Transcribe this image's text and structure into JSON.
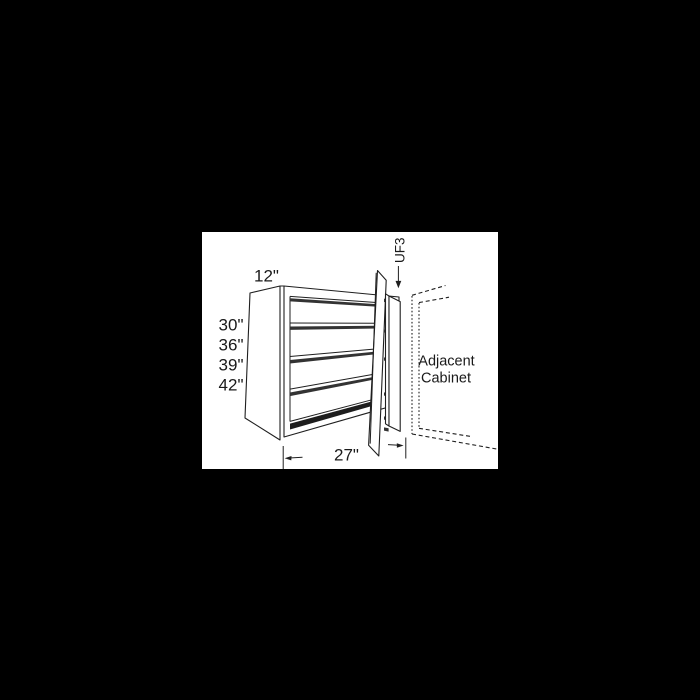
{
  "scene": {
    "background_color": "#000000",
    "paper_color": "#ffffff",
    "line_color": "#1f1f1f",
    "description": "Technical dimension drawing of a blind corner wall cabinet with open door, universal filler and adjacent cabinet shown dashed"
  },
  "diagram": {
    "type": "cabinet-dimension-drawing",
    "depth_label": "12\"",
    "height_labels": [
      "30\"",
      "36\"",
      "39\"",
      "42\""
    ],
    "width_label": "27\"",
    "filler_label": "UF3",
    "adjacent_label_line1": "Adjacent",
    "adjacent_label_line2": "Cabinet"
  }
}
